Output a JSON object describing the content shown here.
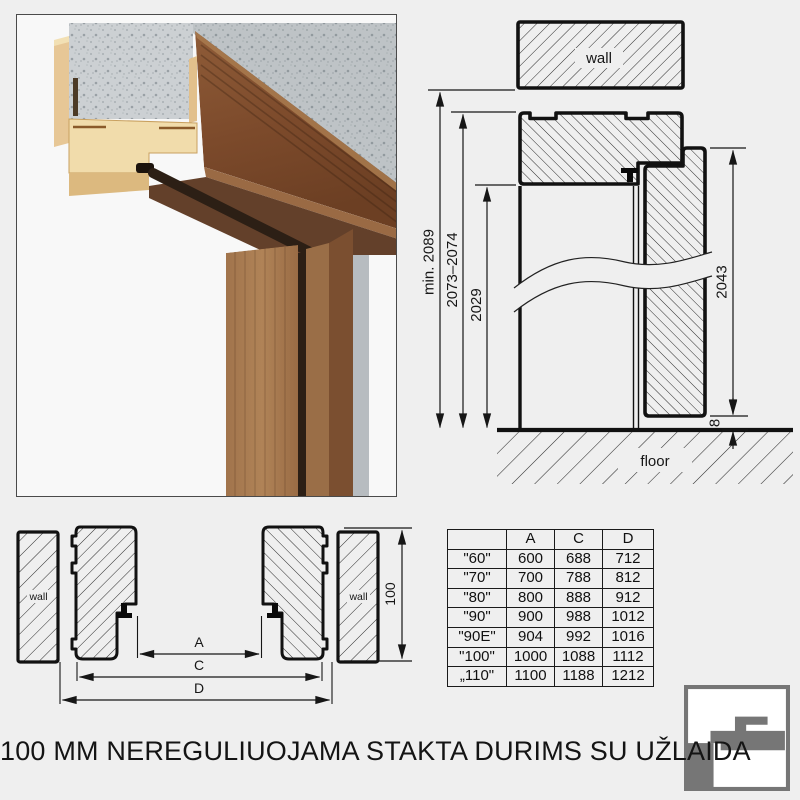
{
  "title": "100 MM NEREGULIUOJAMA STAKTA DURIMS SU UŽLAIDA",
  "elevation": {
    "wall_label": "wall",
    "floor_label": "floor",
    "dim_total_height": "min. 2089",
    "dim_frame_height": "2073–2074",
    "dim_opening_height": "2029",
    "dim_leaf_height": "2043",
    "dim_floor_gap": "8"
  },
  "section": {
    "wall_left_label": "wall",
    "wall_right_label": "wall",
    "dim_frame_depth": "100",
    "dim_a_label": "A",
    "dim_c_label": "C",
    "dim_d_label": "D"
  },
  "table": {
    "headers": [
      "",
      "A",
      "C",
      "D"
    ],
    "rows": [
      {
        "size": "\"60\"",
        "a": "600",
        "c": "688",
        "d": "712"
      },
      {
        "size": "\"70\"",
        "a": "700",
        "c": "788",
        "d": "812"
      },
      {
        "size": "\"80\"",
        "a": "800",
        "c": "888",
        "d": "912"
      },
      {
        "size": "\"90\"",
        "a": "900",
        "c": "988",
        "d": "1012"
      },
      {
        "size": "\"90E\"",
        "a": "904",
        "c": "992",
        "d": "1016"
      },
      {
        "size": "\"100\"",
        "a": "1000",
        "c": "1088",
        "d": "1112"
      },
      {
        "size": "„110\"",
        "a": "1100",
        "c": "1188",
        "d": "1212"
      }
    ]
  },
  "logo": {
    "name": "door-frame-profile-logo"
  },
  "colors": {
    "background": "#efefef",
    "line": "#161616",
    "wood_dark": "#7c4d2e",
    "wood_light": "#a97c52",
    "mdf_tan": "#e7c796",
    "concrete_gray": "#ccd0d3",
    "seal_dark": "#2c1f15",
    "logo_gray": "#767676"
  }
}
